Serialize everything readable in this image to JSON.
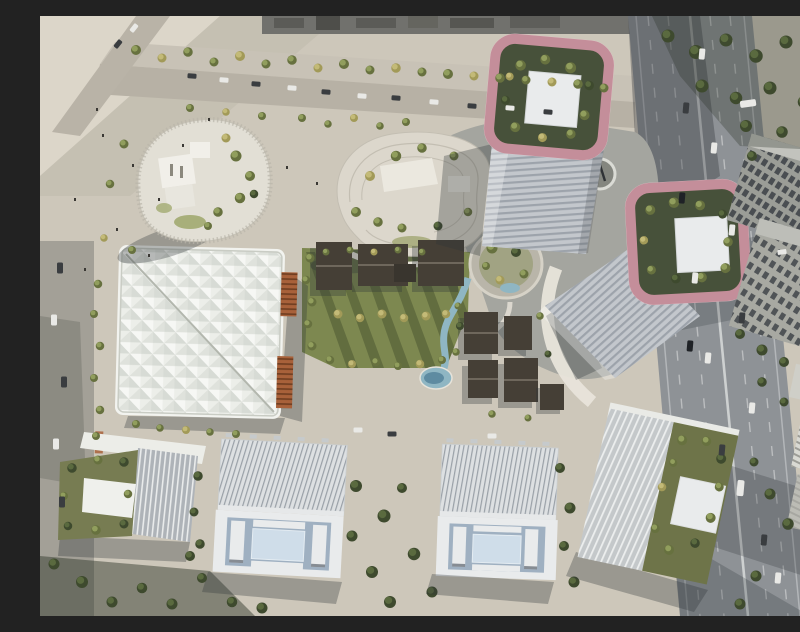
{
  "scene": {
    "type": "aerial-architectural-rendering",
    "setting": "Bird's-eye rendering of a mixed-use development masterplan beside a multi-lane highway",
    "landmarks": {
      "pink_towers": "Two high-rise towers crowned with rose-pink rounded rooftop frames enclosing tree-filled roof gardens with white skylight squares",
      "crystal_hall": "Large square hall with faceted white glass roof, diagonal seam and copper louver panels",
      "podium_terraces": "Two organic pebble-shaped podium buildings with planted roof terraces",
      "heritage_cluster": "Low dark-roofed courtyard houses around a central lawn, stream and pond",
      "courtyard_slabs": "Two white slab buildings with ribbed roofs and blue inner courtyards",
      "ribbed_offices": "White vertically-ribbed office blocks with rooftop tree gardens",
      "highway": "Diagonal multi-lane highway with traffic on the right edge",
      "park": "Central lawn with tree rows, winding stream, oval sunken garden and plazas"
    }
  },
  "palette": {
    "plaza": "#cdc7ba",
    "plaza_light": "#dcd6c9",
    "plaza_shade": "#b7b1a5",
    "road": "#a3a097",
    "highway": "#8e9296",
    "lane": "#d8dadb",
    "lawn": "#7d8850",
    "water": "#8fb6c3",
    "water_deep": "#5e8ba1",
    "white_roof": "#e9ebec",
    "courtyard": "#9fb0c1",
    "courtyard_inner": "#cfdde9",
    "pink": "#c48e9a",
    "pink_light": "#e6c6cc",
    "roof_garden": "#47513a",
    "tower_facade": "#c3c7cc",
    "crystal_roof": "#eceee9",
    "crystal_facet": "#c7ccc4",
    "copper": "#a8613a",
    "copper_dark": "#6f3d20",
    "village_dark": "#453f36",
    "office_gray": "#9b9d97",
    "office_gray2": "#a8a9a2",
    "window_dark": "#41454a",
    "distant": "#71716d",
    "podium": "#a4a59f",
    "path_white": "#e8e4da",
    "shadow": "rgba(48,53,55,0.32)"
  }
}
